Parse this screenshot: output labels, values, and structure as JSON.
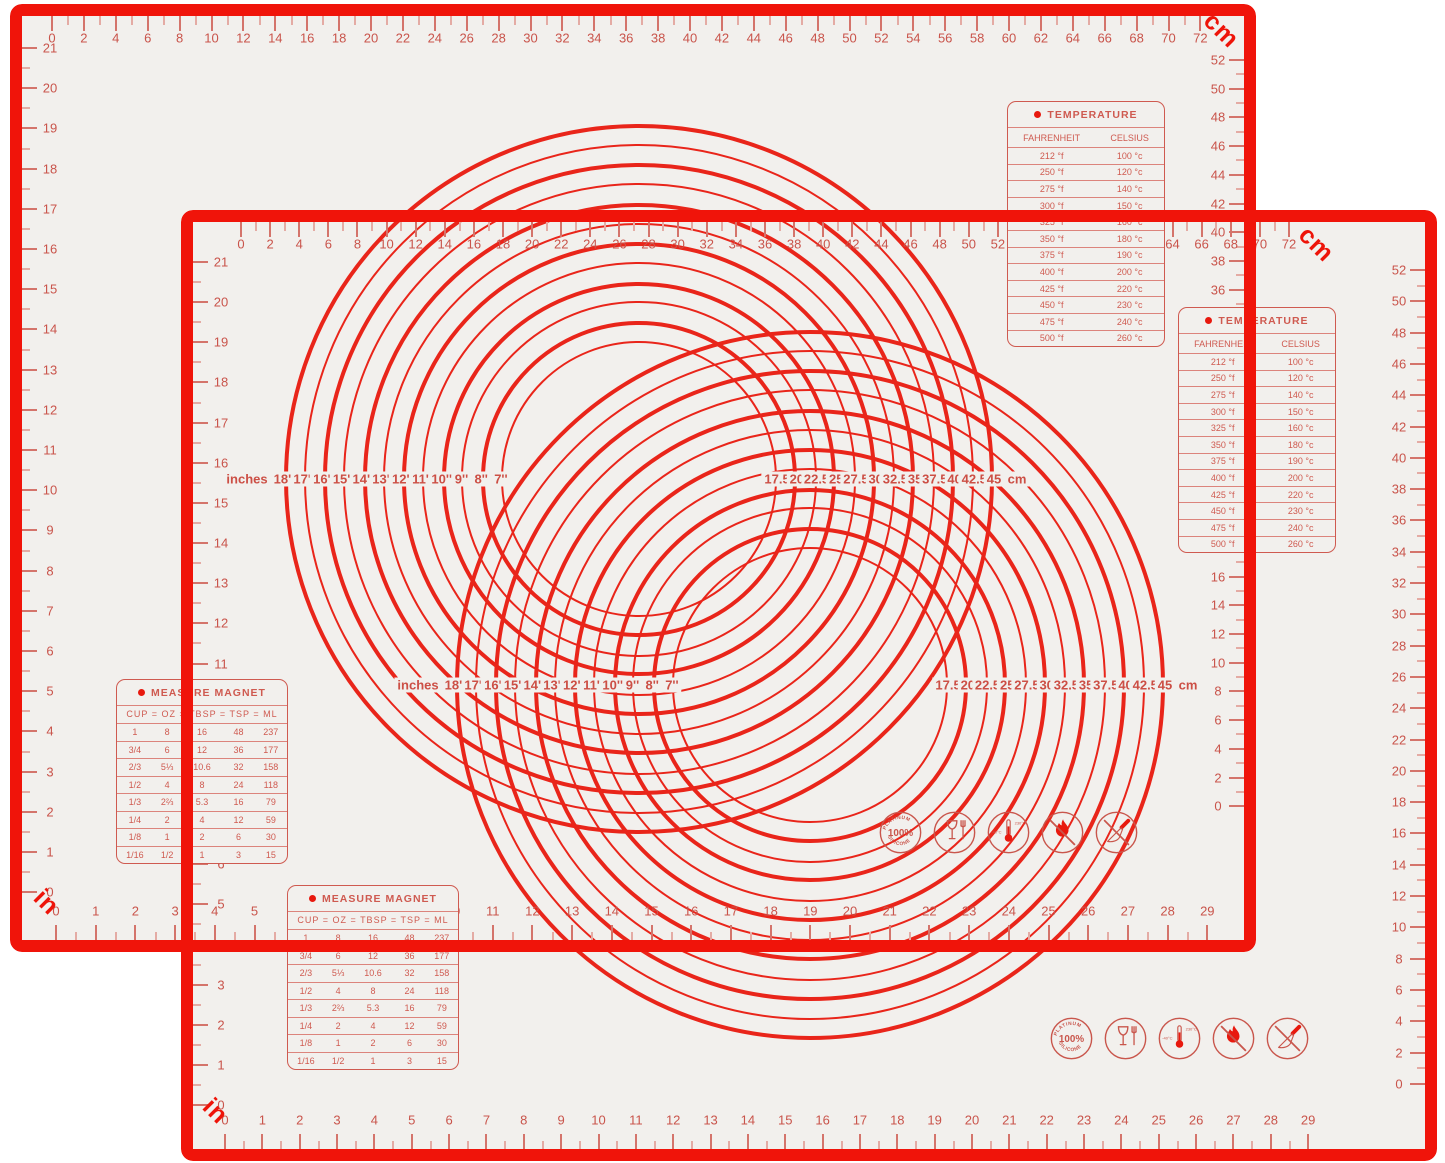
{
  "colors": {
    "mat_background": "#f2f0ed",
    "border_red": "#f0140a",
    "ruler_red": "#c9544b",
    "bright_red": "#e8190e",
    "panel_red": "#cf5a50"
  },
  "mat": {
    "cm_unit_label": "cm",
    "in_unit_label": "in",
    "top_ruler_cm": [
      0,
      2,
      4,
      6,
      8,
      10,
      12,
      14,
      16,
      18,
      20,
      22,
      24,
      26,
      28,
      30,
      32,
      34,
      36,
      38,
      40,
      42,
      44,
      46,
      48,
      50,
      52,
      54,
      56,
      58,
      60,
      62,
      64,
      66,
      68,
      70,
      72
    ],
    "right_ruler_cm": [
      52,
      50,
      48,
      46,
      44,
      42,
      40,
      38,
      36,
      34,
      32,
      30,
      28,
      26,
      24,
      22,
      20,
      18,
      16,
      14,
      12,
      10,
      8,
      6,
      4,
      2,
      0
    ],
    "left_ruler_in": [
      21,
      20,
      19,
      18,
      17,
      16,
      15,
      14,
      13,
      12,
      11,
      10,
      9,
      8,
      7,
      6,
      5,
      4,
      3,
      2,
      1,
      0
    ],
    "bottom_ruler_in": [
      0,
      1,
      2,
      3,
      4,
      5,
      6,
      7,
      8,
      9,
      10,
      11,
      12,
      13,
      14,
      15,
      16,
      17,
      18,
      19,
      20,
      21,
      22,
      23,
      24,
      25,
      26,
      27,
      28,
      29
    ],
    "circle_gauge": {
      "left_unit": "inches",
      "inch_diameters": [
        "18''",
        "17''",
        "16''",
        "15''",
        "14''",
        "13''",
        "12''",
        "11''",
        "10''",
        "9''",
        "8''",
        "7''"
      ],
      "cm_diameters": [
        "17.5",
        "20",
        "22.5",
        "25",
        "27.5",
        "30",
        "32.5",
        "35",
        "37.5",
        "40",
        "42.5",
        "45"
      ],
      "right_unit": "cm"
    },
    "temperature_table": {
      "title": "TEMPERATURE",
      "columns": [
        "FAHRENHEIT",
        "CELSIUS"
      ],
      "rows": [
        [
          "212 °f",
          "100 °c"
        ],
        [
          "250 °f",
          "120 °c"
        ],
        [
          "275 °f",
          "140 °c"
        ],
        [
          "300 °f",
          "150 °c"
        ],
        [
          "325 °f",
          "160 °c"
        ],
        [
          "350 °f",
          "180 °c"
        ],
        [
          "375 °f",
          "190 °c"
        ],
        [
          "400 °f",
          "200 °c"
        ],
        [
          "425 °f",
          "220 °c"
        ],
        [
          "450 °f",
          "230 °c"
        ],
        [
          "475 °f",
          "240 °c"
        ],
        [
          "500 °f",
          "260 °c"
        ]
      ]
    },
    "measure_table": {
      "title": "MEASURE MAGNET",
      "columns": [
        "CUP",
        "OZ",
        "TBSP",
        "TSP",
        "ML"
      ],
      "rows": [
        [
          "1",
          "8",
          "16",
          "48",
          "237"
        ],
        [
          "3/4",
          "6",
          "12",
          "36",
          "177"
        ],
        [
          "2/3",
          "5⅓",
          "10.6",
          "32",
          "158"
        ],
        [
          "1/2",
          "4",
          "8",
          "24",
          "118"
        ],
        [
          "1/3",
          "2⅔",
          "5.3",
          "16",
          "79"
        ],
        [
          "1/4",
          "2",
          "4",
          "12",
          "59"
        ],
        [
          "1/8",
          "1",
          "2",
          "6",
          "30"
        ],
        [
          "1/16",
          "1/2",
          "1",
          "3",
          "15"
        ]
      ]
    },
    "icons": [
      {
        "name": "platinum-silicone-icon",
        "arc_top": "PLATINUM",
        "center": "100%",
        "arc_bottom": "SILICONE"
      },
      {
        "name": "food-safe-icon"
      },
      {
        "name": "temperature-range-icon",
        "min": "-40°C",
        "max": "230°C"
      },
      {
        "name": "flame-resistant-icon"
      },
      {
        "name": "no-knife-icon"
      }
    ]
  }
}
